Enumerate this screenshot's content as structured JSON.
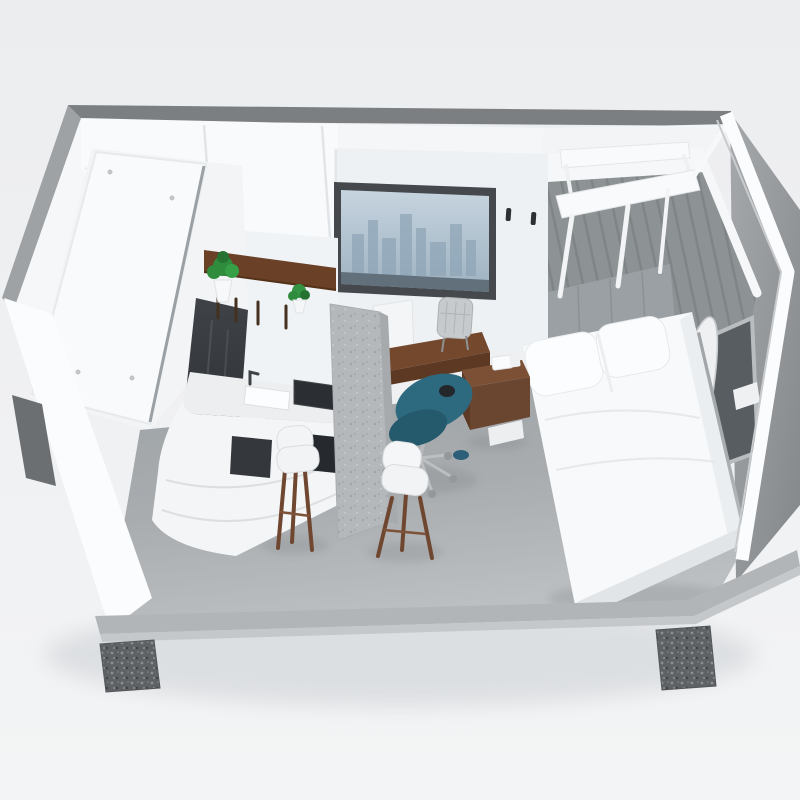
{
  "meta": {
    "title": "Compact studio apartment - 3D cutaway render",
    "description": "High-angle isometric 3D cutaway render of a compact prefab studio apartment module on concrete footings, containing a bathroom pod, kitchenette with shelf and plants, bar stools, wooden desk with teal office chair, city-view window, double bed with white bedding, grey plank accent wall, wall-mounted white canopy frame and a surfboard",
    "render_style": "3d-architectural-visualization",
    "camera": "high-angle front-left isometric"
  },
  "colors": {
    "background": "#edeef0",
    "unit_shadow": "#d9dcdf",
    "shell_top": "#7c7f82",
    "shell_left": "#9fa2a5",
    "wall_white": "#f5f7f8",
    "ceiling": "#f8fafb",
    "back_wall": "#eef1f3",
    "kitchen_wall": "#f0f3f5",
    "plank_wall": "#8d9295",
    "headboard": "#9aa0a4",
    "canopy_white": "#f8fafb",
    "window_frame": "#45494e",
    "skyline": "#8fa6b7",
    "glass_band": "#62707c",
    "wood_desk": "#74482d",
    "wood_desk_front": "#5d3923",
    "wood_shelf": "#6a4126",
    "plant_green": "#2f8c3d",
    "counter_white": "#f3f5f6",
    "cooktop_black": "#2b2f33",
    "appliance_dark": "#34383c",
    "island_gray": "#b5b8ba",
    "stool_seat": "#f2f4f5",
    "stool_leg": "#6f4730",
    "chair_teal": "#2d6a80",
    "chair_teal_seat": "#25596c",
    "desk_chair_gray": "#c7cacc",
    "bed_white": "#f7f9fa",
    "bed_base": "#e2e5e7",
    "pillow_white": "#fcfdfe",
    "nightstand_wood": "#7b5034",
    "surfboard_white": "#eef0f1",
    "surfboard_wood": "#78492c",
    "shower_glass_dark": "#2f3337",
    "pod_white": "#f2f4f6",
    "slab_white": "#f8fafb",
    "base_platform": "#b2b5b7",
    "base_lip": "#c5c8ca",
    "trim_white": "#fbfcfd",
    "sink_white": "#fcfdfe",
    "side_window_glass": "#585d61"
  },
  "objects": {
    "rooms": [
      "kitchenette",
      "work area",
      "sleeping area",
      "bathroom pod"
    ],
    "furniture": [
      "bathroom pod",
      "shower glass panel",
      "kitchen shelf",
      "potted plant large",
      "potted plant small",
      "curved kitchen counter",
      "cooktop",
      "sink",
      "island column",
      "bar stool left",
      "bar stool right",
      "wooden desk",
      "desk cabinet",
      "folding mesh chair",
      "teal office chair",
      "double bed",
      "pillows",
      "headboard",
      "wall canopy frame",
      "nightstand",
      "surfboard",
      "side window",
      "city view window",
      "wall hooks",
      "concrete footings"
    ]
  }
}
